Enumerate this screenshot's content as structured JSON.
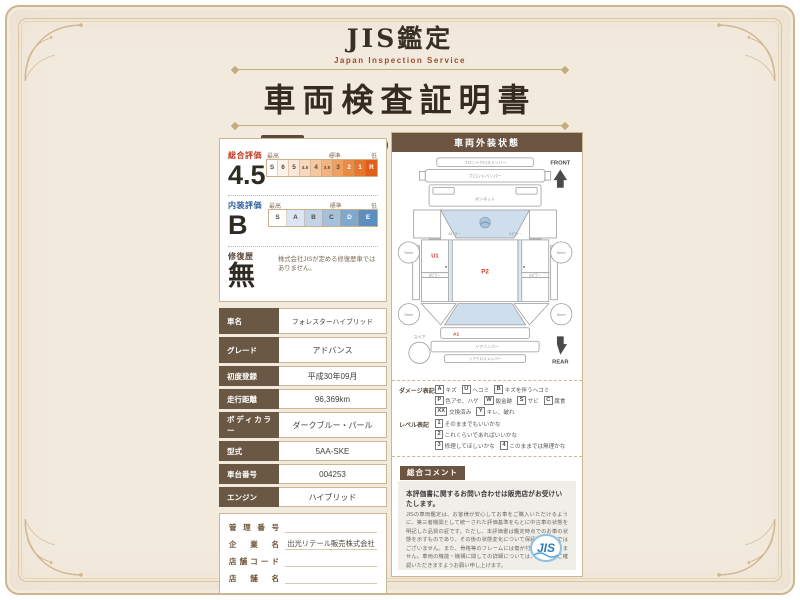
{
  "header": {
    "brand": "JIS鑑定",
    "brand_sub": "Japan Inspection Service",
    "title": "車両検査証明書",
    "date_label": "鑑定日",
    "date_value": "2025/10/12(日)",
    "id_label": "車両ID",
    "id_value": "2510120015"
  },
  "ratings": {
    "overall": {
      "label": "総合評価",
      "value": "4.5",
      "legend": {
        "high": "最高",
        "mid": "標準",
        "low": "低"
      },
      "cells": [
        "S",
        "6",
        "5",
        "4.5",
        "4",
        "3.5",
        "3",
        "2",
        "1",
        "R"
      ]
    },
    "interior": {
      "label": "内装評価",
      "value": "B",
      "legend": {
        "high": "最高",
        "mid": "標準",
        "low": "低"
      },
      "cells": [
        "S",
        "A",
        "B",
        "C",
        "D",
        "E"
      ]
    },
    "repair": {
      "label": "修復歴",
      "value": "無",
      "note": "株式会社JISが定める修復歴車ではありません。"
    }
  },
  "vehicle_info": {
    "rows": [
      {
        "label": "車名",
        "value": "フォレスターハイブリッド"
      },
      {
        "label": "グレード",
        "value": "アドバンス"
      },
      {
        "label": "初度登録",
        "value": "平成30年09月"
      },
      {
        "label": "走行距離",
        "value": "96,369km"
      },
      {
        "label": "ボディカラー",
        "value": "ダークブルー・パール"
      },
      {
        "label": "型式",
        "value": "5AA-SKE"
      },
      {
        "label": "車台番号",
        "value": "004253"
      },
      {
        "label": "エンジン",
        "value": "ハイブリッド"
      }
    ]
  },
  "dealer_info": {
    "rows": [
      {
        "label": "管理番号",
        "value": ""
      },
      {
        "label": "企業名",
        "value": "出光リテール販売株式会社"
      },
      {
        "label": "店舗コード",
        "value": ""
      },
      {
        "label": "店舗名",
        "value": ""
      }
    ],
    "inspector": {
      "label": "検査担当",
      "value": "株式会社JIS1"
    }
  },
  "exterior": {
    "title": "車両外装状態",
    "front_label": "FRONT",
    "rear_label": "REAR",
    "spare_label": "スペア",
    "wheel_label": "5mm",
    "marks": {
      "door": "U1",
      "roof": "P2",
      "rear": "A1"
    },
    "parts": {
      "front_cross": "フロントクロスメンバー",
      "front_bumper": "フロントバンパー",
      "bonnet": "ボンネット",
      "a_pillar": "Aピラー",
      "b_pillar": "Bピラー",
      "rear_bumper": "リアバンパー",
      "rear_cross": "リアクロスメンバー"
    },
    "damage": {
      "label": "ダメージ表記",
      "items": [
        {
          "s": "A",
          "t": "キズ"
        },
        {
          "s": "U",
          "t": "ヘコミ"
        },
        {
          "s": "B",
          "t": "キズを伴うヘコミ"
        },
        {
          "s": "P",
          "t": "色アセ、ハゲ"
        },
        {
          "s": "W",
          "t": "鈑金跡"
        },
        {
          "s": "S",
          "t": "サビ"
        },
        {
          "s": "C",
          "t": "腐食"
        },
        {
          "s": "XX",
          "t": "交換済み"
        },
        {
          "s": "Y",
          "t": "キレ、破れ"
        }
      ]
    },
    "level": {
      "label": "レベル表記",
      "items": [
        {
          "s": "1",
          "t": "そのままでもいいかな"
        },
        {
          "s": "2",
          "t": "これくらいであればいいかな"
        },
        {
          "s": "3",
          "t": "修理してほしいかな"
        },
        {
          "s": "4",
          "t": "このままでは無理かな"
        }
      ]
    },
    "comment": {
      "label": "総合コメント",
      "lines": [
        "シートシワ",
        "Rスポ小ハゲ",
        "外装ウスA、U"
      ]
    },
    "disclaimer": {
      "heading": "本評価書に関するお問い合わせは販売店がお受けいたします。",
      "body": "JISの車両鑑定は、お客様が安心してお車をご購入いただけるように、第三者機関として統一された評価基準をもとに中古車の状態を明記した品質の証です。ただし、本評価書は鑑定時点でのお車の状態を示すものであり、その後の状態変化について保証するものではございません。また、骨格等のフレームには傷が付けられておりません。車両の機能・機構に関しての詳細については、販売店にご確認いただきますようお願い申し上げます。",
      "logo_text": "JIS"
    }
  },
  "colors": {
    "certificate_bg": "#f3eade",
    "frame_gold": "#cdb68f",
    "label_brown": "#6b5844",
    "overall_red": "#c23b22",
    "interior_blue": "#2f5f9e",
    "scale_orange_max": "#df5f1a",
    "scale_blue_max": "#5a8fc0",
    "damage_mark_red": "#d03a2a",
    "logo_blue": "#2e7cb8"
  }
}
